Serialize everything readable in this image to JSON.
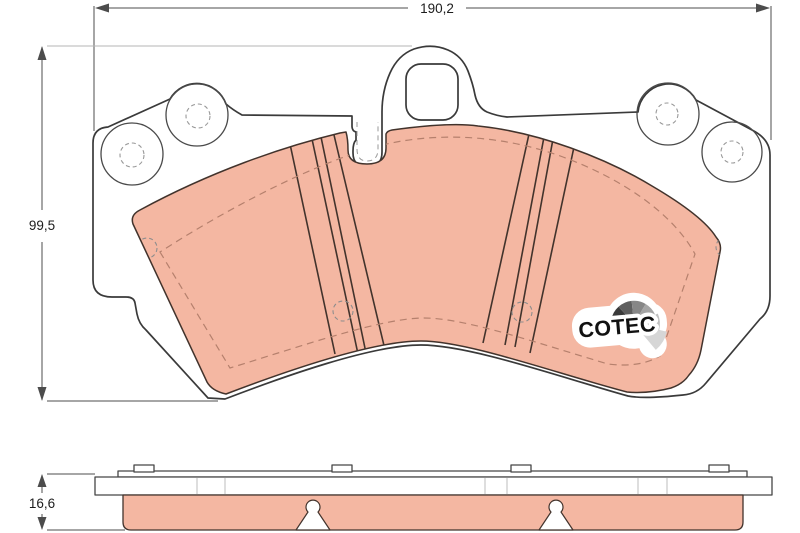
{
  "drawing": {
    "title": "brake pad technical drawing",
    "dim_width": "190,2",
    "dim_height": "99,5",
    "dim_thickness": "16,6"
  },
  "logo": {
    "text": "COTEC",
    "fan_segment_colors": [
      "#141414",
      "#3a3a3a",
      "#5f5f5f",
      "#878787",
      "#a5a5a5",
      "#c0c0c0",
      "#d6d6d6"
    ]
  },
  "colors": {
    "friction_fill": "#f4b7a2",
    "friction_edge": "#42332c",
    "outline": "#3a3a3a",
    "chamfer_dash": "#b5806d",
    "dimension_line": "#4c4c4c"
  }
}
